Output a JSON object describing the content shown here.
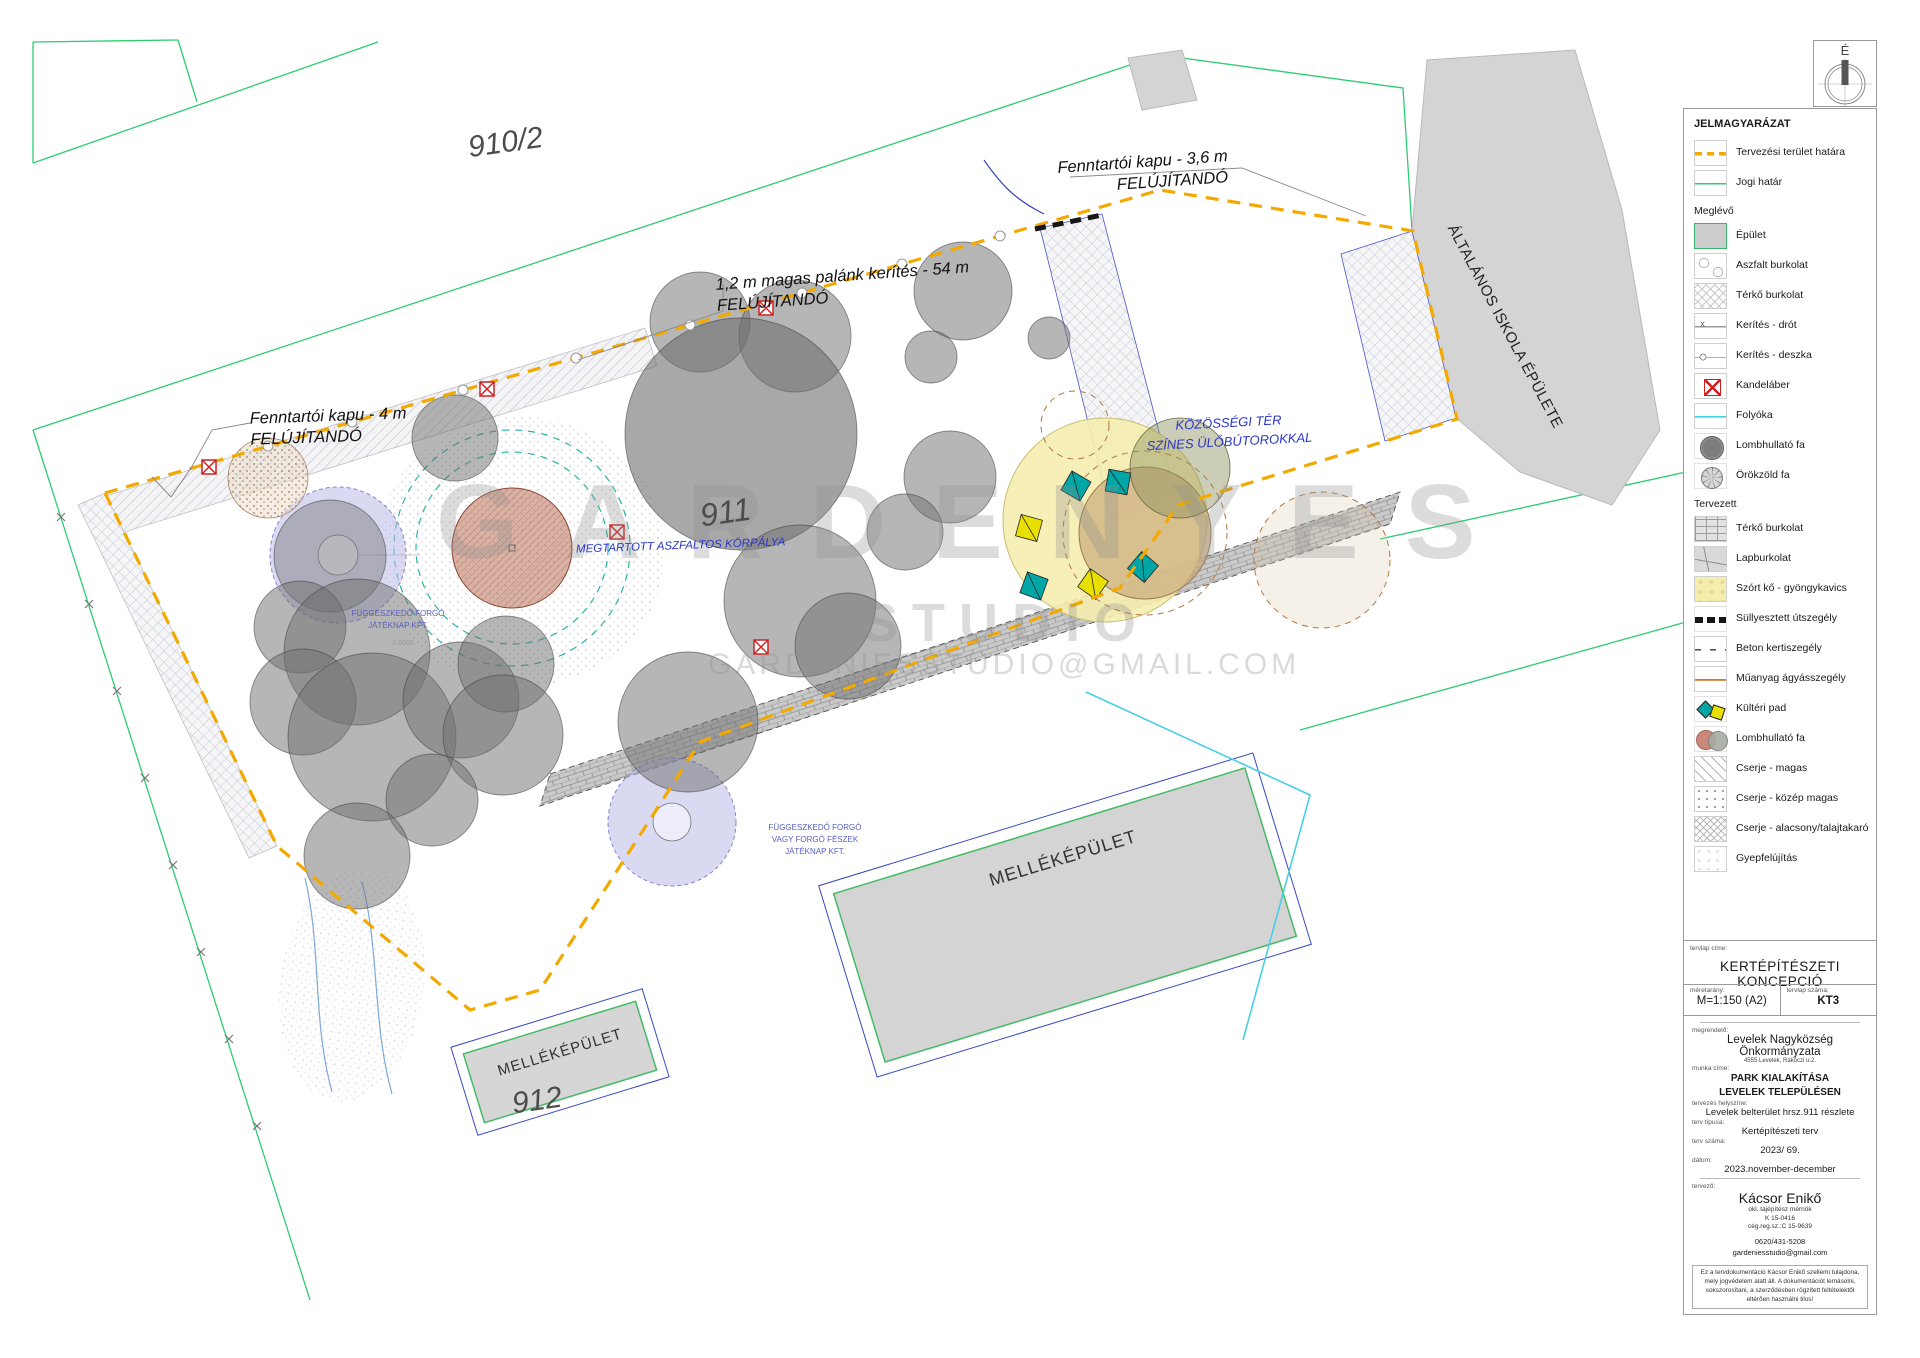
{
  "north": {
    "label": "É"
  },
  "watermark": {
    "line1": "GARDENYES",
    "line2": "STUDIO",
    "line3": "GARDENIESSTUDIO@GMAIL.COM"
  },
  "plan": {
    "parcel_1": "910/2",
    "parcel_2": "911",
    "parcel_3": "912",
    "school_label": "ÁLTALÁNOS ISKOLA ÉPÜLETE",
    "outbuilding_small": "MELLÉKÉPÜLET",
    "outbuilding_large": "MELLÉKÉPÜLET",
    "gate_top": {
      "line1": "Fenntartói kapu - 3,6 m",
      "line2": "FELÚJÍTANDÓ"
    },
    "fence": {
      "line1": "1,2 m magas palánk kerítés - 54 m",
      "line2": "FELÚJÍTANDÓ"
    },
    "gate_left": {
      "line1": "Fenntartói kapu - 4 m",
      "line2": "FELÚJÍTANDÓ"
    },
    "community": {
      "line1": "KÖZÖSSÉGI TÉR",
      "line2": "SZÍNES ÜLŐBÚTOROKKAL"
    },
    "ring": "MEGTARTOTT ASZFALTOS KÖRPÁLYA",
    "play1": {
      "line1": "FÜGGESZKEDŐ FORGÓ",
      "line2": "JÁTÉKNAP KFT."
    },
    "play2": {
      "line1": "FÜGGESZKEDŐ FORGÓ",
      "line2": "VAGY FORGÓ FÉSZEK",
      "line3": "JÁTÉKNAP KFT."
    },
    "dim1": "3.0000"
  },
  "legend": {
    "title": "JELMAGYARÁZAT",
    "general": [
      {
        "label": "Tervezési terület határa"
      },
      {
        "label": "Jogi határ"
      }
    ],
    "existing_header": "Meglévő",
    "existing": [
      {
        "label": "Épület"
      },
      {
        "label": "Aszfalt burkolat"
      },
      {
        "label": "Térkő burkolat"
      },
      {
        "label": "Kerítés - drót"
      },
      {
        "label": "Kerítés - deszka"
      },
      {
        "label": "Kandeláber"
      },
      {
        "label": "Folyóka"
      },
      {
        "label": "Lombhullató fa"
      },
      {
        "label": "Örökzöld fa"
      }
    ],
    "planned_header": "Tervezett",
    "planned": [
      {
        "label": "Térkő burkolat"
      },
      {
        "label": "Lapburkolat"
      },
      {
        "label": "Szórt kő - gyöngykavics"
      },
      {
        "label": "Süllyesztett útszegély"
      },
      {
        "label": "Beton kertiszegély"
      },
      {
        "label": "Műanyag ágyásszegély"
      },
      {
        "label": "Kültéri pad"
      },
      {
        "label": "Lombhullató fa"
      },
      {
        "label": "Cserje - magas"
      },
      {
        "label": "Cserje - közép magas"
      },
      {
        "label": "Cserje - alacsony/talajtakaró"
      },
      {
        "label": "Gyepfelújítás"
      }
    ]
  },
  "titleblock": {
    "sheet_title_label": "tervlap címe:",
    "sheet_title": "KERTÉPÍTÉSZETI KONCEPCIÓ",
    "scale_label": "méretarány:",
    "scale": "M=1:150 (A2)",
    "sheet_no_label": "tervlap száma:",
    "sheet_no": "KT3",
    "client_label": "megrendelő:",
    "client": "Levelek Nagyközség Önkormányzata",
    "client_address": "4555 Levelek, Rákóczi u.2.",
    "work_label": "munka címe:",
    "work_line1": "PARK KIALAKÍTÁSA",
    "work_line2": "LEVELEK TELEPÜLÉSEN",
    "location_label": "tervezés helyszíne:",
    "location": "Levelek belterület hrsz.911 részlete",
    "type_label": "terv típusa:",
    "type": "Kertépítészeti terv",
    "number_label": "terv száma:",
    "number": "2023/ 69.",
    "date_label": "dátum:",
    "date": "2023.november-december",
    "designer_label": "tervező:",
    "designer": "Kácsor Enikő",
    "designer_title": "okl. tájépítész mérnök",
    "designer_reg1": "K 15-0416",
    "designer_reg2": "cég.reg.sz.:C 15-9639",
    "phone": "0620/431-5208",
    "email": "gardeniesstudio@gmail.com",
    "disclaimer": "Ez a tervdokumentáció Kácsor Enikő szellemi tulajdona, mely jogvédelem alatt áll. A dokumentációt lemásolni, sokszorosítani, a szerződésben rögzített feltételektől eltérően használni tilos!"
  },
  "colors": {
    "boundary_orange": "#f2a900",
    "legal_green": "#2ecc71",
    "annotation_blue": "#2a35c8",
    "bench_teal": "#00a5a5",
    "bench_yellow": "#e8e000",
    "gravel_yellow": "#f5edaf",
    "asphalt_ring_terracotta": "#b5654a",
    "lamp_red": "#cc2222",
    "gutter_cyan": "#41cfe2"
  }
}
